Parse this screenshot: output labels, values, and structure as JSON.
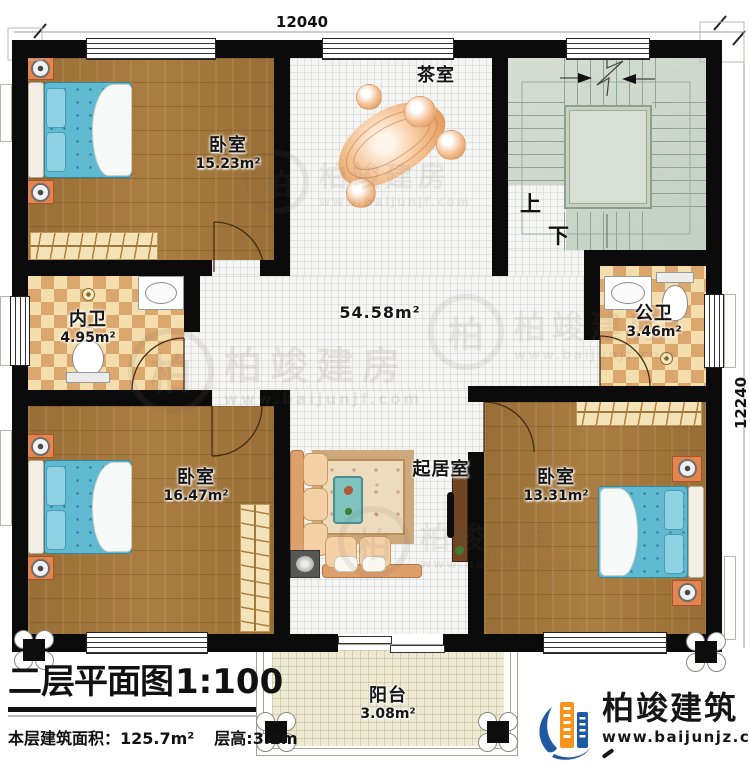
{
  "plan": {
    "dim_top": "12040",
    "dim_right": "12240",
    "rooms": {
      "bedroom_tl": {
        "name": "卧室",
        "area": "15.23m²"
      },
      "tea_room": {
        "name": "茶室"
      },
      "stairs": {
        "up": "上",
        "down": "下"
      },
      "inner_bath": {
        "name": "内卫",
        "area": "4.95m²"
      },
      "public_bath": {
        "name": "公卫",
        "area": "3.46m²"
      },
      "hall": {
        "area": "54.58m²"
      },
      "bedroom_bl": {
        "name": "卧室",
        "area": "16.47m²"
      },
      "living_room": {
        "name": "起居室"
      },
      "bedroom_br": {
        "name": "卧室",
        "area": "13.31m²"
      },
      "balcony": {
        "name": "阳台",
        "area": "3.08m²"
      }
    }
  },
  "title_block": {
    "title": "二层平面图",
    "scale": "1:100",
    "floor_area": "本层建筑面积：125.7m²",
    "floor_height": "层高:3.2m"
  },
  "brand": {
    "name": "柏竣建筑",
    "website": "www.baijunjz.com"
  },
  "watermark": {
    "seal_char": "柏",
    "name": "柏竣建房",
    "website": "www.baijunjf.com"
  },
  "colors": {
    "wall": "#0b0b0b",
    "wood_floor": "#a87c41",
    "checker": "#dca76c",
    "stair_floor": "#ccd7cb",
    "bed": "#5fb9d1",
    "brand_blue": "#1e5aa4",
    "brand_orange": "#f7941e"
  }
}
